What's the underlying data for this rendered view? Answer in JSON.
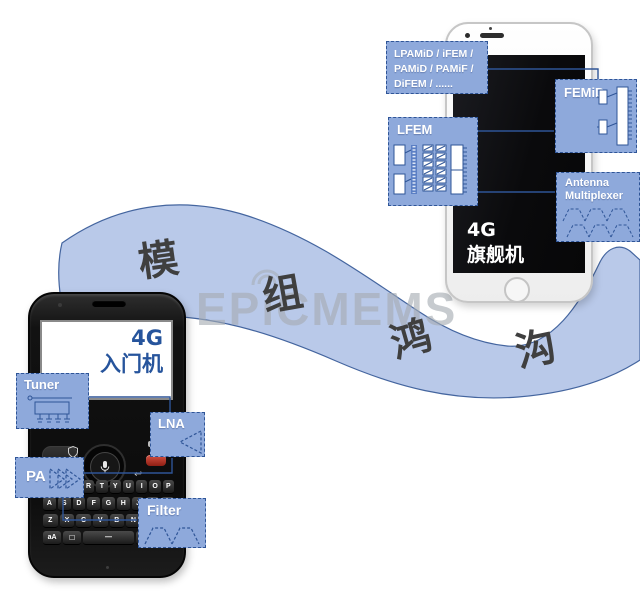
{
  "banner": {
    "chars": [
      "模",
      "组",
      "鸿",
      "沟"
    ]
  },
  "watermark": {
    "text": "EPiCMEMS"
  },
  "entry_phone": {
    "screen_line1": "4G",
    "screen_line2": "入门机",
    "keyboard": {
      "rows": [
        [
          "Q",
          "W",
          "E",
          "R",
          "T",
          "Y",
          "U",
          "I",
          "O",
          "P"
        ],
        [
          "A",
          "S",
          "D",
          "F",
          "G",
          "H",
          "J",
          "K",
          "L"
        ],
        [
          "Z",
          "X",
          "C",
          "V",
          "B",
          "N",
          "M",
          "⌫"
        ]
      ],
      "bottom_row": [
        "aA",
        "☐",
        "—",
        "sym",
        "aA"
      ]
    }
  },
  "flagship_phone": {
    "screen_line1": "4G",
    "screen_line2": "旗舰机"
  },
  "component_labels": {
    "module_list_lines": [
      "LPAMiD / iFEM /",
      "PAMiD / PAMiF /",
      "DiFEM / ......"
    ],
    "femid": "FEMiD",
    "lfem": "LFEM",
    "antenna_multiplexer_line1": "Antenna",
    "antenna_multiplexer_line2": "Multiplexer",
    "tuner": "Tuner",
    "lna": "LNA",
    "pa": "PA",
    "filter": "Filter"
  },
  "colors": {
    "banner_fill": "#b9c9e9",
    "banner_stroke": "#44659f",
    "tag_fill": "#8ea9db",
    "tag_border": "#2f5597",
    "connector": "#2e5496",
    "schematic_stroke": "#2f5597",
    "entry_screen_text": "#26549c",
    "flagship_screen_text": "#ffffff",
    "banner_char_color": "#3f3f3f",
    "watermark_color": "#a6acb3",
    "end_call_key": "#c0392b"
  }
}
